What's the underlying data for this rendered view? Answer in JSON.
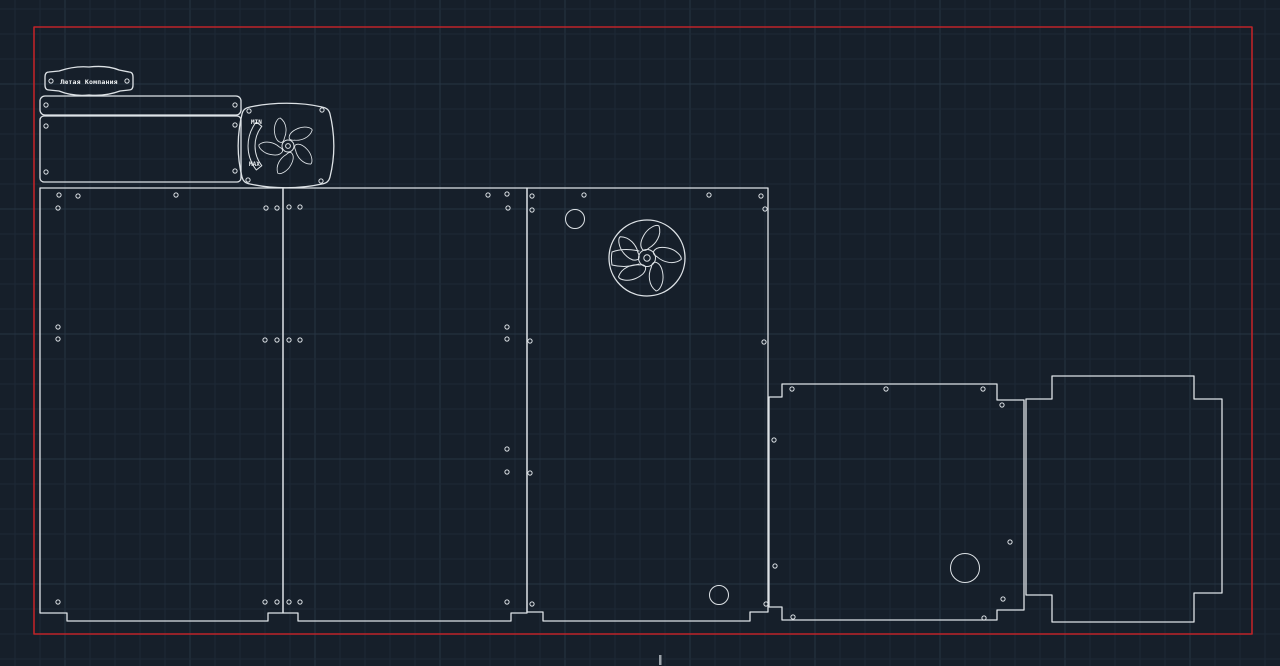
{
  "scene": {
    "width": 1280,
    "height": 666,
    "colors": {
      "background": "#161f2a",
      "grid_minor": "#1d2836",
      "grid_major": "#263443",
      "outline": "#dde2e6",
      "border": "#bd2429",
      "text": "#f2f5f7",
      "tick": "#9aa1a8"
    },
    "grid": {
      "minor_step": 25,
      "major_step": 125,
      "x_offset": 15,
      "y_offset": 9,
      "x_major_offset": 65,
      "y_major_offset": 84
    }
  },
  "labels": {
    "tag": "Лютая Компания",
    "fan_min": "MIN",
    "fan_max": "MAX"
  },
  "drawing": {
    "shapes": [
      {
        "name": "sheet-boundary",
        "el": "rect",
        "cls": "ln red",
        "inter": true,
        "attrs": {
          "x": 34,
          "y": 27,
          "width": 1218,
          "height": 607
        }
      },
      {
        "name": "name-tag-plate",
        "el": "path",
        "cls": "ln",
        "inter": true,
        "attrs": {
          "d": "M 49,72 C 46,72 45,74 45,77 L 45,85 C 45,88 46,90 49,90 L 59,91 C 69,95 79,96 89,95 C 101,96 112,94 120,91 L 129,90 C 132,90 133,88 133,85 L 133,77 C 133,74 132,72 129,72 L 119,70 C 109,66 98,66 89,67 C 78,66 68,68 59,71 Z"
        }
      },
      {
        "name": "top-strip-plate",
        "el": "rect",
        "cls": "ln",
        "inter": true,
        "attrs": {
          "x": 40,
          "y": 96,
          "width": 201,
          "height": 19,
          "rx": 5
        }
      },
      {
        "name": "back-plate",
        "el": "rect",
        "cls": "ln",
        "inter": true,
        "attrs": {
          "x": 40,
          "y": 116,
          "width": 201,
          "height": 66,
          "rx": 4
        }
      },
      {
        "name": "fan-grill-plate",
        "el": "path",
        "cls": "ln",
        "inter": true,
        "attrs": {
          "d": "M 250,107 C 273,102 301,102 322,107 C 327,108 329,110 330,114 C 335,135 335,157 330,177 C 329,181 327,183 322,184 C 299,189 273,189 250,184 C 245,183 243,181 242,177 C 237,157 237,135 242,114 C 243,110 245,108 250,107 Z"
        }
      },
      {
        "name": "fan-grill-blade",
        "el": "path",
        "cls": "ln thin",
        "inter": false,
        "attrs": {
          "d": "M 2,-10 C 9,-14 15,-23 12,-32 C 9,-34 1,-30 -3,-23 C -7,-16 -7,-11 -4,-8 C -2,-7 0,-8 2,-10 Z",
          "transform": "translate(288,146) rotate(36) scale(0.85)"
        }
      },
      {
        "name": "fan-grill-blade",
        "el": "path",
        "cls": "ln thin",
        "inter": false,
        "attrs": {
          "d": "M 2,-10 C 9,-14 15,-23 12,-32 C 9,-34 1,-30 -3,-23 C -7,-16 -7,-11 -4,-8 C -2,-7 0,-8 2,-10 Z",
          "transform": "translate(288,146) rotate(108) scale(0.85)"
        }
      },
      {
        "name": "fan-grill-blade",
        "el": "path",
        "cls": "ln thin",
        "inter": false,
        "attrs": {
          "d": "M 2,-10 C 9,-14 15,-23 12,-32 C 9,-34 1,-30 -3,-23 C -7,-16 -7,-11 -4,-8 C -2,-7 0,-8 2,-10 Z",
          "transform": "translate(288,146) rotate(180) scale(0.85)"
        }
      },
      {
        "name": "fan-grill-blade",
        "el": "path",
        "cls": "ln thin",
        "inter": false,
        "attrs": {
          "d": "M 2,-10 C 9,-14 15,-23 12,-32 C 9,-34 1,-30 -3,-23 C -7,-16 -7,-11 -4,-8 C -2,-7 0,-8 2,-10 Z",
          "transform": "translate(288,146) rotate(252) scale(0.85)"
        }
      },
      {
        "name": "fan-grill-blade",
        "el": "path",
        "cls": "ln thin",
        "inter": false,
        "attrs": {
          "d": "M 2,-10 C 9,-14 15,-23 12,-32 C 9,-34 1,-30 -3,-23 C -7,-16 -7,-11 -4,-8 C -2,-7 0,-8 2,-10 Z",
          "transform": "translate(288,146) rotate(324) scale(0.85)"
        }
      },
      {
        "name": "fan-grill-hub",
        "el": "circle",
        "cls": "ln thin",
        "inter": false,
        "attrs": {
          "cx": 288,
          "cy": 146,
          "r": 6
        }
      },
      {
        "name": "fan-grill-hub-hole",
        "el": "circle",
        "cls": "ln thin",
        "inter": false,
        "attrs": {
          "cx": 288,
          "cy": 146,
          "r": 2.4
        }
      },
      {
        "name": "fan-dial-arc",
        "el": "path",
        "cls": "ln thin",
        "inter": true,
        "attrs": {
          "d": "M 256.3,122 A 39,39 0 0 0 256.3,170 L 261.8,165.7 A 32,32 0 0 1 261.8,126.3 Z"
        }
      },
      {
        "name": "panel-left",
        "el": "path",
        "cls": "ln",
        "inter": true,
        "attrs": {
          "d": "M 40,188 L 283,188 L 283,613 L 268,613 L 268,621 L 67,621 L 67,613 L 40,613 Z"
        }
      },
      {
        "name": "panel-middle",
        "el": "path",
        "cls": "ln",
        "inter": true,
        "attrs": {
          "d": "M 283,188 L 527,188 L 527,613 L 511,613 L 511,621 L 298,621 L 298,613 L 283,613 Z"
        }
      },
      {
        "name": "panel-fan-side",
        "el": "path",
        "cls": "ln",
        "inter": true,
        "attrs": {
          "d": "M 527,188 L 768,188 L 768,612 L 750,612 L 750,621 L 543,621 L 543,612 L 527,612 Z"
        }
      },
      {
        "name": "vent-hole-circle",
        "el": "circle",
        "cls": "ln thin",
        "inter": true,
        "attrs": {
          "cx": 575,
          "cy": 219,
          "r": 9.5
        }
      },
      {
        "name": "fan-cutout-ring",
        "el": "circle",
        "cls": "ln",
        "inter": true,
        "attrs": {
          "cx": 647,
          "cy": 258,
          "r": 38
        }
      },
      {
        "name": "fan-cutout-blade",
        "el": "path",
        "cls": "ln thin",
        "inter": false,
        "attrs": {
          "d": "M 2,-10 C 9,-14 15,-23 12,-32 C 9,-34 1,-30 -3,-23 C -7,-16 -7,-11 -4,-8 C -2,-7 0,-8 2,-10 Z",
          "transform": "translate(647,258) rotate(0)"
        }
      },
      {
        "name": "fan-cutout-blade",
        "el": "path",
        "cls": "ln thin",
        "inter": false,
        "attrs": {
          "d": "M 2,-10 C 9,-14 15,-23 12,-32 C 9,-34 1,-30 -3,-23 C -7,-16 -7,-11 -4,-8 C -2,-7 0,-8 2,-10 Z",
          "transform": "translate(647,258) rotate(72)"
        }
      },
      {
        "name": "fan-cutout-blade",
        "el": "path",
        "cls": "ln thin",
        "inter": false,
        "attrs": {
          "d": "M 2,-10 C 9,-14 15,-23 12,-32 C 9,-34 1,-30 -3,-23 C -7,-16 -7,-11 -4,-8 C -2,-7 0,-8 2,-10 Z",
          "transform": "translate(647,258) rotate(144)"
        }
      },
      {
        "name": "fan-cutout-blade",
        "el": "path",
        "cls": "ln thin",
        "inter": false,
        "attrs": {
          "d": "M 2,-10 C 9,-14 15,-23 12,-32 C 9,-34 1,-30 -3,-23 C -7,-16 -7,-11 -4,-8 C -2,-7 0,-8 2,-10 Z",
          "transform": "translate(647,258) rotate(216)"
        }
      },
      {
        "name": "fan-cutout-blade",
        "el": "path",
        "cls": "ln thin",
        "inter": false,
        "attrs": {
          "d": "M 2,-10 C 9,-14 15,-23 12,-32 C 9,-34 1,-30 -3,-23 C -7,-16 -7,-11 -4,-8 C -2,-7 0,-8 2,-10 Z",
          "transform": "translate(647,258) rotate(288)"
        }
      },
      {
        "name": "fan-cutout-slot",
        "el": "path",
        "cls": "ln thin",
        "inter": false,
        "attrs": {
          "d": "M 639,251 C 630,249 620,249 612,252 A 37,37 0 0 0 612,265 C 620,267 630,267 639,264"
        }
      },
      {
        "name": "fan-cutout-hub",
        "el": "circle",
        "cls": "ln thin",
        "inter": false,
        "attrs": {
          "cx": 647,
          "cy": 258,
          "r": 8.5
        }
      },
      {
        "name": "fan-cutout-hub-hole",
        "el": "circle",
        "cls": "ln thin",
        "inter": false,
        "attrs": {
          "cx": 647,
          "cy": 258,
          "r": 3.2
        }
      },
      {
        "name": "cable-hole-circle",
        "el": "circle",
        "cls": "ln thin",
        "inter": true,
        "attrs": {
          "cx": 719,
          "cy": 595,
          "r": 9.5
        }
      },
      {
        "name": "panel-bottom",
        "el": "path",
        "cls": "ln",
        "inter": true,
        "attrs": {
          "d": "M 769,397 L 782,397 L 782,384 L 997,384 L 997,400 L 1024,400 L 1024,610 L 997,610 L 997,620 L 782,620 L 782,607 L 769,607 Z"
        }
      },
      {
        "name": "bottom-panel-hole-circle",
        "el": "circle",
        "cls": "ln thin",
        "inter": true,
        "attrs": {
          "cx": 965,
          "cy": 568,
          "r": 14.5
        }
      },
      {
        "name": "panel-side-cross",
        "el": "path",
        "cls": "ln",
        "inter": true,
        "attrs": {
          "d": "M 1052,376 L 1194,376 L 1194,399 L 1222,399 L 1222,593 L 1194,593 L 1194,622 L 1052,622 L 1052,595 L 1026,595 L 1026,399 L 1052,399 Z"
        }
      },
      {
        "name": "cursor-tick",
        "el": "rect",
        "cls": "solid",
        "inter": false,
        "attrs": {
          "x": 659,
          "y": 655,
          "width": 2.5,
          "height": 10
        }
      }
    ],
    "holes": {
      "r": 2.1,
      "centers": [
        [
          51,
          81
        ],
        [
          127,
          81
        ],
        [
          46,
          105
        ],
        [
          235,
          105
        ],
        [
          46,
          126
        ],
        [
          235,
          125
        ],
        [
          46,
          172
        ],
        [
          235,
          171
        ],
        [
          249,
          111
        ],
        [
          322,
          110
        ],
        [
          248,
          180
        ],
        [
          321,
          181
        ],
        [
          59,
          195
        ],
        [
          78,
          196
        ],
        [
          176,
          195
        ],
        [
          58,
          208
        ],
        [
          266,
          208
        ],
        [
          277,
          208
        ],
        [
          58,
          327
        ],
        [
          58,
          339
        ],
        [
          265,
          340
        ],
        [
          277,
          340
        ],
        [
          58,
          602
        ],
        [
          265,
          602
        ],
        [
          277,
          602
        ],
        [
          289,
          207
        ],
        [
          300,
          207
        ],
        [
          289,
          340
        ],
        [
          300,
          340
        ],
        [
          289,
          602
        ],
        [
          300,
          602
        ],
        [
          488,
          195
        ],
        [
          507,
          194
        ],
        [
          508,
          208
        ],
        [
          507,
          327
        ],
        [
          507,
          339
        ],
        [
          507,
          449
        ],
        [
          507,
          472
        ],
        [
          507,
          602
        ],
        [
          530,
          341
        ],
        [
          530,
          473
        ],
        [
          532,
          196
        ],
        [
          532,
          210
        ],
        [
          532,
          604
        ],
        [
          584,
          195
        ],
        [
          709,
          195
        ],
        [
          761,
          196
        ],
        [
          765,
          209
        ],
        [
          764,
          342
        ],
        [
          766,
          604
        ],
        [
          775,
          566
        ],
        [
          792,
          389
        ],
        [
          886,
          389
        ],
        [
          983,
          389
        ],
        [
          1002,
          405
        ],
        [
          774,
          440
        ],
        [
          1010,
          542
        ],
        [
          1003,
          599
        ],
        [
          793,
          617
        ],
        [
          984,
          618
        ]
      ]
    }
  }
}
